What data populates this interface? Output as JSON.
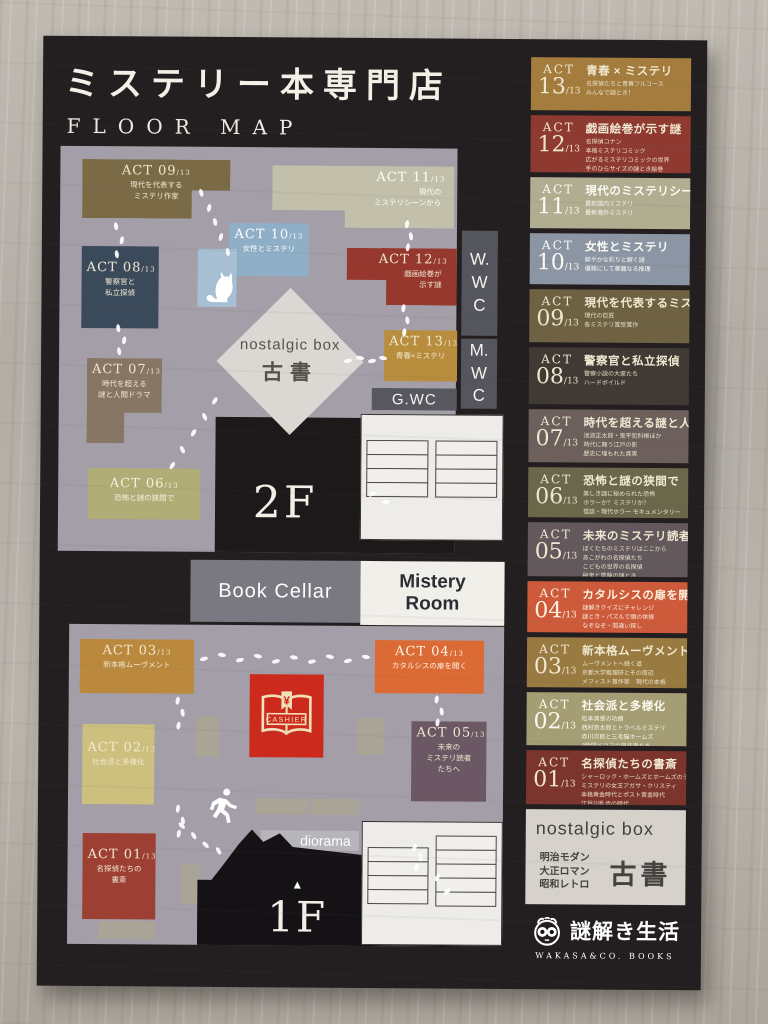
{
  "poster": {
    "title": "ミステリー本専門店",
    "subtitle": "FLOOR MAP"
  },
  "floor2": {
    "label": "2F",
    "areas": {
      "act09": {
        "act": "ACT 09",
        "den": "13",
        "lines": [
          "現代を代表する",
          "ミステリ作家"
        ]
      },
      "act11": {
        "act": "ACT 11",
        "den": "13",
        "lines": [
          "現代の",
          "ミステリシーンから"
        ]
      },
      "act10": {
        "act": "ACT 10",
        "den": "13",
        "lines": [
          "女性とミステリ"
        ]
      },
      "act12": {
        "act": "ACT 12",
        "den": "13",
        "lines": [
          "戯画絵巻が",
          "示す謎"
        ]
      },
      "act13": {
        "act": "ACT 13",
        "den": "13",
        "lines": [
          "青春×ミステリ"
        ]
      },
      "act08": {
        "act": "ACT 08",
        "den": "13",
        "lines": [
          "警察官と",
          "私立探偵"
        ]
      },
      "act07": {
        "act": "ACT 07",
        "den": "13",
        "lines": [
          "時代を超える",
          "謎と人間ドラマ"
        ]
      },
      "act06": {
        "act": "ACT 06",
        "den": "13",
        "lines": [
          "恐怖と謎の狭間で"
        ]
      }
    },
    "wc": {
      "w": [
        "W.",
        "W",
        "C"
      ],
      "m": [
        "M.",
        "W",
        "C"
      ],
      "g": "G.WC"
    },
    "nostalgic": {
      "title": "nostalgic box",
      "subtitle": "古書"
    }
  },
  "floor1": {
    "label": "1F",
    "up_arrow": "▲",
    "banners": {
      "book_cellar": "Book Cellar",
      "mistery_room": [
        "Mistery",
        "Room"
      ]
    },
    "areas": {
      "act03": {
        "act": "ACT 03",
        "den": "13",
        "lines": [
          "新本格ムーヴメント"
        ]
      },
      "act04": {
        "act": "ACT 04",
        "den": "13",
        "lines": [
          "カタルシスの扉を開く"
        ]
      },
      "act02": {
        "act": "ACT 02",
        "den": "13",
        "lines": [
          "社会派と多様化"
        ]
      },
      "act05": {
        "act": "ACT 05",
        "den": "13",
        "lines": [
          "未来の",
          "ミステリ読者",
          "たちへ"
        ]
      },
      "act01": {
        "act": "ACT 01",
        "den": "13",
        "lines": [
          "名探偵たちの",
          "書斎"
        ]
      }
    },
    "cashier": {
      "label": "CASHIER",
      "symbol": "¥"
    },
    "diorama_label": "diorama"
  },
  "sidebar": {
    "entries": [
      {
        "act": "ACT",
        "num": "13",
        "den": "13",
        "title": "青春 × ミステリ",
        "lines": [
          "名探偵たちと青春フルコース",
          "みんなで謎とき！"
        ]
      },
      {
        "act": "ACT",
        "num": "12",
        "den": "13",
        "title": "戯画絵巻が示す謎",
        "lines": [
          "名探偵コナン",
          "本格ミステリコミック",
          "広がるミステリコミックの世界",
          "手のひらサイズの謎とき絵巻"
        ]
      },
      {
        "act": "ACT",
        "num": "11",
        "den": "13",
        "title": "現代のミステリシーンから",
        "lines": [
          "最新国内ミステリ",
          "最新海外ミステリ"
        ]
      },
      {
        "act": "ACT",
        "num": "10",
        "den": "13",
        "title": "女性とミステリ",
        "lines": [
          "鮮やかな彩りと解く謎",
          "優雅にして華麗なる推理"
        ]
      },
      {
        "act": "ACT",
        "num": "09",
        "den": "13",
        "title": "現代を代表するミステリ作家",
        "lines": [
          "現代の巨匠",
          "各ミステリ賞受賞作"
        ]
      },
      {
        "act": "ACT",
        "num": "08",
        "den": "13",
        "title": "警察官と私立探偵",
        "lines": [
          "警察小説の大家たち",
          "ハードボイルド"
        ]
      },
      {
        "act": "ACT",
        "num": "07",
        "den": "13",
        "title": "時代を超える謎と人間ドラマ",
        "lines": [
          "池波正太郎・鬼平犯科帳ほか",
          "時代に舞う江戸の影",
          "歴史に埋もれた真実"
        ]
      },
      {
        "act": "ACT",
        "num": "06",
        "den": "13",
        "title": "恐怖と謎の狭間で",
        "lines": [
          "美しき謎に秘められた恐怖",
          "ホラーか？ミステリか？",
          "怪談・現代ホラー モキュメンタリー"
        ]
      },
      {
        "act": "ACT",
        "num": "05",
        "den": "13",
        "title": "未来のミステリ読者たちへ",
        "lines": [
          "ぼくたちのミステリはここから",
          "あこがれの名探偵たち",
          "こどもの世界の名探偵",
          "秘宝と冒険の謎とき"
        ]
      },
      {
        "act": "ACT",
        "num": "04",
        "den": "13",
        "title": "カタルシスの扉を開く",
        "lines": [
          "謎解きクイズにチャレンジ",
          "謎とき・パズルで頭の体操",
          "なぞなぞ・間違い探し"
        ]
      },
      {
        "act": "ACT",
        "num": "03",
        "den": "13",
        "title": "新本格ムーヴメント",
        "lines": [
          "ムーヴメントへ続く道",
          "京都大学推理研とその周辺",
          "メフィスト賞作家　現代の本格",
          "日常の謎　ミステリアンソロジー"
        ]
      },
      {
        "act": "ACT",
        "num": "02",
        "den": "13",
        "title": "社会派と多様化",
        "lines": [
          "松本清張の功績",
          "西村京太郎とトラベルミステリ",
          "赤川次郎と三毛猫ホームズ",
          "2時間ドラマの原作者たち"
        ]
      },
      {
        "act": "ACT",
        "num": "01",
        "den": "13",
        "title": "名探偵たちの書斎",
        "lines": [
          "シャーロック・ホームズとホームズのライバルたち",
          "ミステリの女王アガサ・クリスティ",
          "本格黄金時代とポスト黄金時代",
          "江戸川乱歩の時代"
        ]
      }
    ],
    "nostalgic": {
      "title": "nostalgic box",
      "lines": [
        "明治モダン",
        "大正ロマン",
        "昭和レトロ"
      ],
      "big": "古書"
    },
    "logo": {
      "name": "謎解き生活",
      "sub": "WAKASA&CO. BOOKS"
    }
  },
  "palette": {
    "poster_bg": "#231f21",
    "floor_gray": "#a39ea8",
    "cashier_red": "#cd2a1e",
    "gold": "#b88e3e",
    "orange": "#dc6a35",
    "brick": "#96382e",
    "slate": "#3b4a5b"
  }
}
